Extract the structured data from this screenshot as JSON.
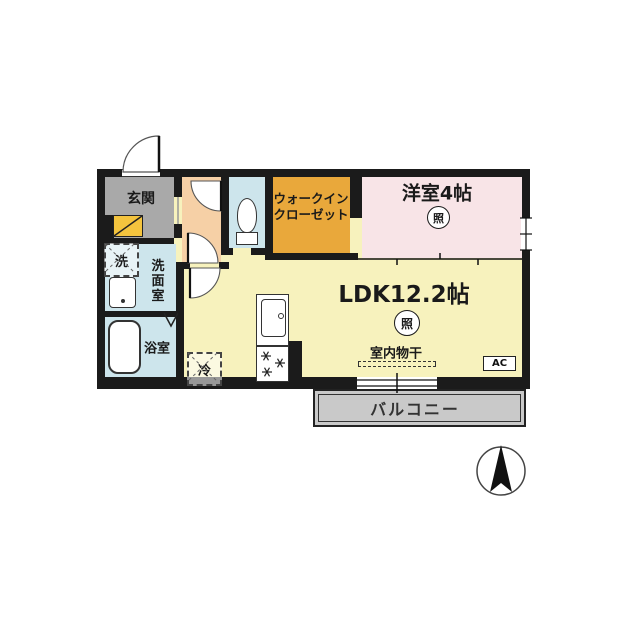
{
  "plan_title": "1LDK floor plan",
  "colors": {
    "wall": "#1b1b1b",
    "genkan": "#a9a9a9",
    "hallway": "#f6d0a6",
    "wet": "#cde5ec",
    "wic": "#e9a83b",
    "bedroom": "#f8e4e7",
    "ldk": "#f7f2bd",
    "balcony": "#c9c9c9",
    "shoe": "#f4c43e"
  },
  "rooms": {
    "genkan": {
      "label": "玄関"
    },
    "washroom": {
      "label": "洗面室"
    },
    "bath": {
      "label": "浴室"
    },
    "wic": {
      "label_line1": "ウォークイン",
      "label_line2": "クローゼット"
    },
    "bedroom": {
      "label": "洋室4帖",
      "light": "照"
    },
    "ldk": {
      "label": "LDK12.2帖",
      "light": "照"
    },
    "balcony": {
      "label": "バルコニー"
    }
  },
  "fixtures": {
    "washer": "洗",
    "fridge": "冷",
    "indoor_laundry": "室内物干",
    "ac": "AC"
  }
}
